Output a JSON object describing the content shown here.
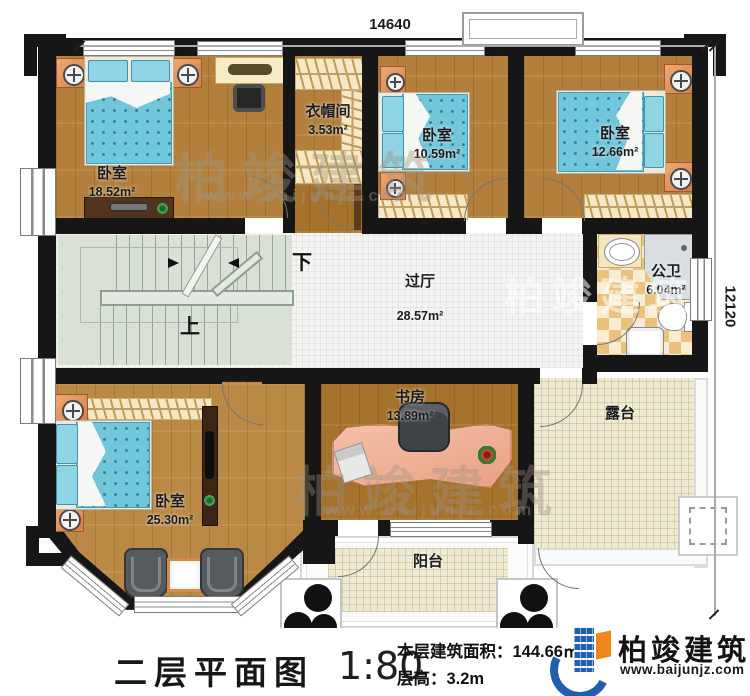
{
  "dimensions": {
    "top": "14640",
    "right": "12120"
  },
  "rooms": [
    {
      "name": "卧室",
      "area": "18.52m²"
    },
    {
      "name": "衣帽间",
      "area": "3.53m²"
    },
    {
      "name": "卧室",
      "area": "10.59m²"
    },
    {
      "name": "卧室",
      "area": "12.66m²"
    },
    {
      "name": "过厅",
      "area": "28.57m²"
    },
    {
      "name": "公卫",
      "area": "6.04m²"
    },
    {
      "name": "卧室",
      "area": "25.30m²"
    },
    {
      "name": "书房",
      "area": "13.89m²"
    },
    {
      "name": "露台",
      "area": ""
    },
    {
      "name": "阳台",
      "area": ""
    }
  ],
  "stairs": {
    "up": "上",
    "down": "下"
  },
  "watermark": {
    "brand": "柏竣建筑",
    "site": "www.baijunjz.com"
  },
  "footer": {
    "title": "二层平面图",
    "scale": "1:80",
    "area_line": "本层建筑面积：144.66㎡",
    "height_line": "层高：3.2m"
  },
  "logo": {
    "brand": "柏竣建筑",
    "site": "www.baijunjz.com"
  },
  "colors": {
    "wall": "#161616",
    "wood": "#b2803c",
    "bed_blue": "#72c6da",
    "terrace_beige": "#eeebd2",
    "brand_blue": "#1f5fae",
    "brand_orange": "#f08519"
  }
}
